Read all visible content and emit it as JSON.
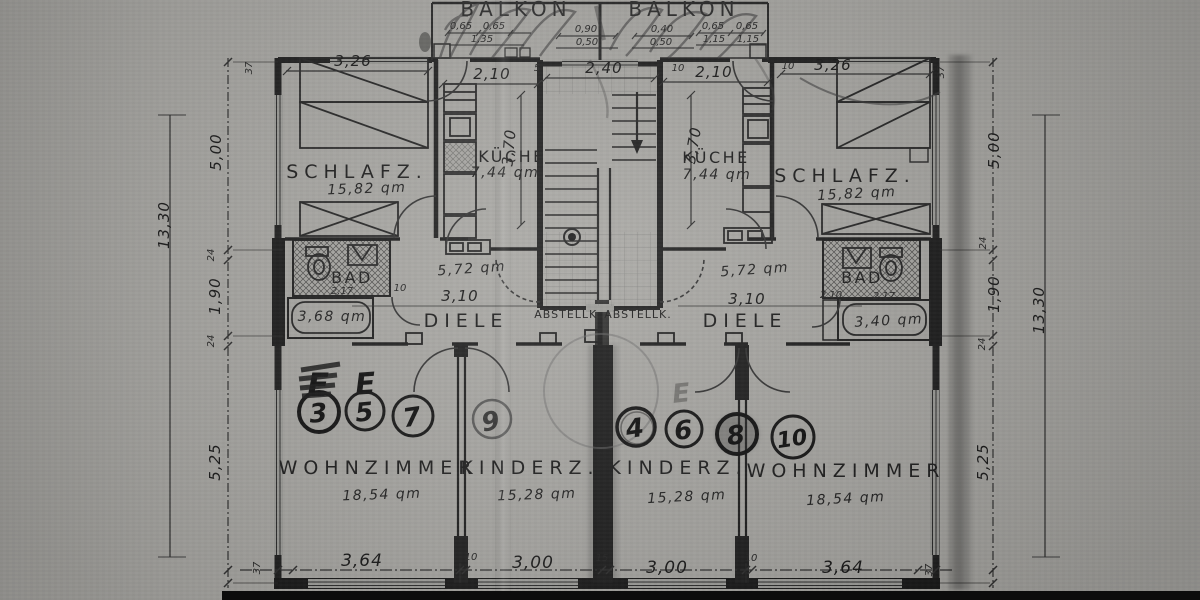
{
  "document": {
    "kind": "scanned architectural floor plan (attic/upper storey, two mirrored flats)"
  },
  "rooms": {
    "balkon_l": {
      "label": "BALKON"
    },
    "balkon_r": {
      "label": "BALKON"
    },
    "schlafz_l": {
      "label": "SCHLAFZ.",
      "area": "15,82 qm"
    },
    "kueche_l": {
      "label": "KÜCHE",
      "area": "7,44 qm"
    },
    "schlafz_r": {
      "label": "SCHLAFZ.",
      "area": "15,82 qm"
    },
    "kueche_r": {
      "label": "KÜCHE",
      "area": "7,44 qm"
    },
    "bad_l": {
      "label": "BAD",
      "width": "2,17",
      "door": "10",
      "tub_area": "3,68 qm"
    },
    "bad_r": {
      "label": "BAD",
      "width": "2,17",
      "width2": "2,10",
      "tub_area": "3,40 qm"
    },
    "diele_l": {
      "label": "DIELE",
      "area": "5,72 qm",
      "width": "3,10"
    },
    "diele_r": {
      "label": "DIELE",
      "area": "5,72 qm",
      "width": "3,10"
    },
    "abstellk_l": {
      "label": "ABSTELLK."
    },
    "abstellk_r": {
      "label": "ABSTELLK."
    },
    "wohnzimmer_l": {
      "label": "WOHNZIMMER",
      "area": "18,54 qm"
    },
    "kinderz_l": {
      "label": "KINDERZ.",
      "area": "15,28 qm"
    },
    "kinderz_r": {
      "label": "KINDERZ.",
      "area": "15,28 qm"
    },
    "wohnzimmer_r": {
      "label": "WOHNZIMMER",
      "area": "18,54 qm"
    }
  },
  "units": {
    "u3": "3",
    "u5": "5",
    "u7": "7",
    "u9": "9",
    "u4": "4",
    "u6": "6",
    "u8": "8",
    "u10": "10"
  },
  "marks": {
    "e1": "E",
    "e2": "E",
    "e3": "E"
  },
  "dims": {
    "outer": "13,30",
    "side": {
      "wall": "37",
      "upper": "5,00",
      "tick24": "24",
      "mid": "1,90",
      "lower": "5,25"
    },
    "bottom": {
      "wall": "37",
      "w1": "3,64",
      "t10": "10",
      "w2": "3,00",
      "t15": "15"
    },
    "top": {
      "bed": "3,26",
      "kitchen": "2,10",
      "stair": "2,40",
      "depth": "3,70",
      "wt5": "5",
      "wt10": "10"
    },
    "balcony": {
      "r1": [
        "0,65",
        "0,65",
        "0,90",
        "0,40",
        "0,65",
        "0,65"
      ],
      "r2": [
        "1,35",
        "0,50",
        "0,50",
        "1,15",
        "1,15"
      ]
    }
  }
}
